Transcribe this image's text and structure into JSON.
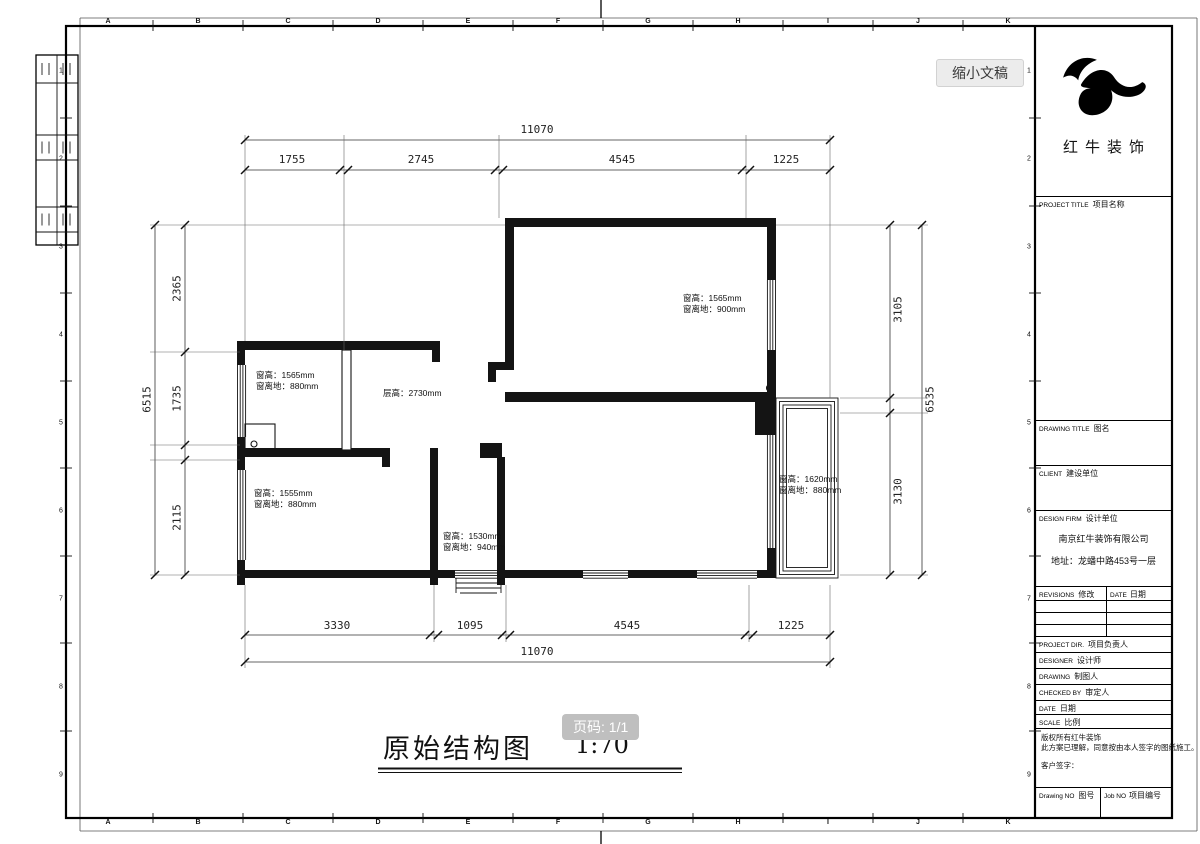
{
  "ui": {
    "shrink_button": "缩小文稿",
    "page_badge": "页码: 1/1"
  },
  "drawing": {
    "title": "原始结构图",
    "scale": "1:70",
    "dimensions": {
      "top_overall": "11070",
      "top_segments": [
        "1755",
        "2745",
        "4545",
        "1225"
      ],
      "bottom_segments": [
        "3330",
        "1095",
        "4545",
        "1225"
      ],
      "bottom_overall": "11070",
      "left_segments": [
        "2365",
        "1735",
        "2115"
      ],
      "left_overall": "6515",
      "right_segments": [
        "3105",
        "3130"
      ],
      "right_overall": "6535"
    },
    "annotations": [
      {
        "lines": [
          "窗高：1565mm",
          "窗离地：880mm"
        ]
      },
      {
        "lines": [
          "层高：2730mm",
          ""
        ]
      },
      {
        "lines": [
          "窗高：1565mm",
          "窗离地：900mm"
        ]
      },
      {
        "lines": [
          "窗高：1555mm",
          "窗离地：880mm"
        ]
      },
      {
        "lines": [
          "窗高：1530mm",
          "窗离地：940mm"
        ]
      },
      {
        "lines": [
          "窗高：1620mm",
          "窗离地：880mm"
        ]
      }
    ],
    "border_letters": [
      "A",
      "B",
      "C",
      "D",
      "E",
      "F",
      "G",
      "H",
      "I",
      "J",
      "K"
    ],
    "border_numbers": [
      "1",
      "2",
      "3",
      "4",
      "5",
      "6",
      "7",
      "8",
      "9"
    ]
  },
  "titleblock": {
    "company": "红牛装饰",
    "rows": {
      "project_title_en": "PROJECT TITLE",
      "project_title_cn": "项目名称",
      "drawing_title_en": "DRAWING TITLE",
      "drawing_title_cn": "图名",
      "client_en": "CLIENT",
      "client_cn": "建设单位",
      "design_firm_en": "DESIGN FIRM",
      "design_firm_cn": "设计单位",
      "firm_name": "南京红牛装饰有限公司",
      "firm_address": "地址：龙蟠中路453号一层",
      "revisions_en": "REVISIONS",
      "revisions_cn": "修改",
      "date_col_en": "DATE",
      "date_col_cn": "日期",
      "project_dir_en": "PROJECT DIR.",
      "project_dir_cn": "项目负责人",
      "designer_en": "DESIGNER",
      "designer_cn": "设计师",
      "drawing_en": "DRAWING",
      "drawing_cn": "制图人",
      "checked_en": "CHECKED BY",
      "checked_cn": "审定人",
      "date_en": "DATE",
      "date_cn": "日期",
      "scale_en": "SCALE",
      "scale_cn": "比例",
      "note_line1": "版权所有红牛装饰",
      "note_line2": "此方案已理解，同意按由本人签字的图纸施工。",
      "note_line3": "客户签字：",
      "drawing_no_en": "Drawing NO",
      "drawing_no_cn": "图号",
      "job_no_en": "Job NO",
      "job_no_cn": "项目编号"
    }
  }
}
